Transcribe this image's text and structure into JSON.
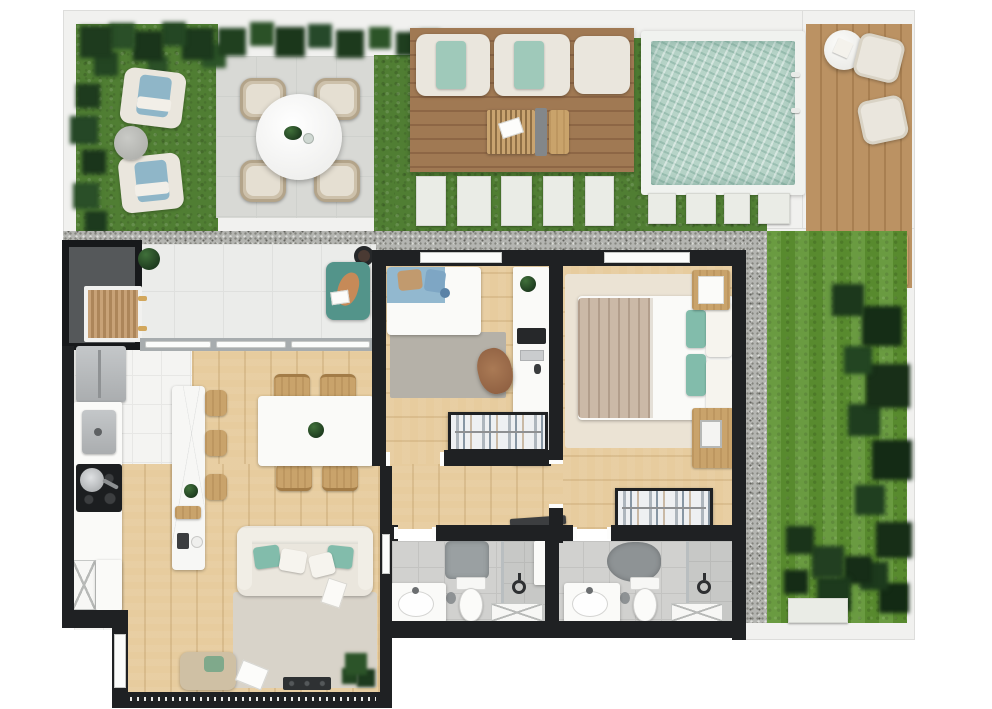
{
  "meta": {
    "kind": "architectural-floor-plan-render",
    "view": "top-down 3D render",
    "canvas": {
      "width": 992,
      "height": 709
    },
    "visible_text": []
  },
  "palette": {
    "wall": "#1f2123",
    "canopy": "#55585a",
    "grass": "#507e33",
    "lawn": "#5d9331",
    "foliage": "#1d3a1e",
    "paver": "#eaece6",
    "patio": "#d8d9d5",
    "deckA": "#a07953",
    "deckB": "#8d6645",
    "poolWater": "#b7d4c8",
    "poolCoping": "#f0f2ef",
    "gravel": "#b4b5b1",
    "gravelDot": "#84857f",
    "woodFloor": "#e7cc9e",
    "woodFurn": "#c9a36b",
    "cream": "#eae6dd",
    "teal": "#82bcab",
    "tealDark": "#53948a",
    "kidsBlue": "#92b8cf",
    "blanket": "#cbb9a7",
    "rugLiving": "#d8d3c9",
    "rugMaster": "#ebe3d4",
    "rugKids": "#b5b1a8",
    "steel": "#b9bcbe",
    "consoleDark": "#2e3133"
  },
  "scene": {
    "outdoor_areas": [
      {
        "name": "garden-lounge",
        "items": [
          "armchair",
          "armchair",
          "round-side-table",
          "tropical-foliage"
        ]
      },
      {
        "name": "patio-dining",
        "items": [
          "round-table",
          "wicker-chair",
          "wicker-chair",
          "wicker-chair",
          "wicker-chair",
          "monstera-leaf",
          "cup"
        ]
      },
      {
        "name": "sun-deck",
        "items": [
          "lounger-with-teal-towel",
          "lounger-with-teal-towel",
          "lounger-plain",
          "slatted-tray-table",
          "book",
          "runner",
          "side-bench"
        ]
      },
      {
        "name": "swimming-pool",
        "items": [
          "coping",
          "water",
          "ladder"
        ]
      },
      {
        "name": "side-deck",
        "items": [
          "round-table",
          "chair",
          "chair",
          "plant-pots"
        ]
      },
      {
        "name": "lawn",
        "items": [
          "shrubs",
          "white-pad"
        ]
      },
      {
        "name": "paths",
        "items": [
          "gravel-walkway-horizontal",
          "gravel-walkway-vertical",
          "stepping-stones-x9"
        ]
      }
    ],
    "rooms": [
      {
        "name": "terrace",
        "items": [
          "entry-canopy",
          "wood-bench",
          "potted-plant",
          "round-grill",
          "teal-pet-bed",
          "sliding-glass-door"
        ]
      },
      {
        "name": "kitchen",
        "items": [
          "fridge",
          "sink",
          "cooktop-with-pan",
          "lattice-cabinet",
          "island",
          "cutting-board",
          "coffee-set",
          "stool",
          "stool",
          "stool"
        ]
      },
      {
        "name": "dining-room",
        "items": [
          "white-table",
          "plant-centerpiece",
          "chair",
          "chair",
          "chair",
          "chair"
        ]
      },
      {
        "name": "living-room",
        "items": [
          "sofa",
          "teal-cushions",
          "rug",
          "daybed",
          "magazine",
          "media-console",
          "floor-plant",
          "glass-door-track"
        ]
      },
      {
        "name": "bedroom-kids",
        "items": [
          "single-bed-blue",
          "gray-rug",
          "desk",
          "monitor",
          "keyboard",
          "office-chair",
          "open-wardrobe"
        ]
      },
      {
        "name": "bedroom-master",
        "items": [
          "double-bed",
          "teal-pillows",
          "pleated-blanket",
          "nightstand",
          "dresser",
          "rug",
          "open-wardrobe"
        ]
      },
      {
        "name": "bathroom-1",
        "items": [
          "vanity-sink",
          "toilet",
          "shower",
          "rain-head",
          "stone-mat",
          "shelf",
          "x-front-cabinet"
        ]
      },
      {
        "name": "bathroom-2",
        "items": [
          "vanity-sink",
          "toilet",
          "shower",
          "rain-head",
          "stone-mat",
          "x-front-cabinet"
        ]
      },
      {
        "name": "hallway",
        "items": [
          "open-door-leaf"
        ]
      }
    ],
    "counts": {
      "stepping_stones": 9,
      "bar_stools": 3,
      "dining_chairs": 4,
      "bathrooms": 2,
      "bedrooms": 2
    }
  }
}
